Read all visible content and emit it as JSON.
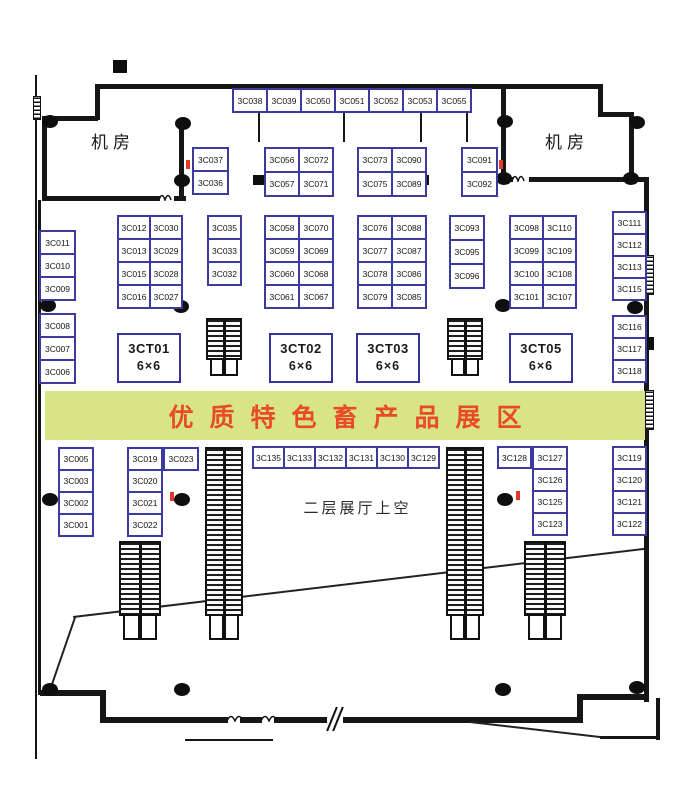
{
  "banner": {
    "text": "优质特色畜产品展区"
  },
  "labels": {
    "machine_room_left": "机房",
    "machine_room_right": "机房",
    "atrium": "二层展厅上空"
  },
  "ct_booths": [
    {
      "name": "3CT01",
      "size": "6×6"
    },
    {
      "name": "3CT02",
      "size": "6×6"
    },
    {
      "name": "3CT03",
      "size": "6×6"
    },
    {
      "name": "3CT05",
      "size": "6×6"
    }
  ],
  "booth_groups": [
    {
      "id": "top-row",
      "labels": [
        [
          "3C038",
          "3C039",
          "3C050",
          "3C051",
          "3C052",
          "3C053",
          "3C055"
        ]
      ]
    },
    {
      "id": "col-3637",
      "labels": [
        [
          "3C037"
        ],
        [
          "3C036"
        ]
      ]
    },
    {
      "id": "blk-56",
      "labels": [
        [
          "3C056",
          "3C072"
        ],
        [
          "3C057",
          "3C071"
        ]
      ]
    },
    {
      "id": "blk-73",
      "labels": [
        [
          "3C073",
          "3C090"
        ],
        [
          "3C075",
          "3C089"
        ]
      ]
    },
    {
      "id": "col-91",
      "labels": [
        [
          "3C091"
        ],
        [
          "3C092"
        ]
      ]
    },
    {
      "id": "col-11",
      "labels": [
        [
          "3C011"
        ],
        [
          "3C010"
        ],
        [
          "3C009"
        ]
      ]
    },
    {
      "id": "blk-12",
      "labels": [
        [
          "3C012",
          "3C030"
        ],
        [
          "3C013",
          "3C029"
        ],
        [
          "3C015",
          "3C028"
        ],
        [
          "3C016",
          "3C027"
        ]
      ]
    },
    {
      "id": "col-35",
      "labels": [
        [
          "3C035"
        ],
        [
          "3C033"
        ],
        [
          "3C032"
        ]
      ]
    },
    {
      "id": "blk-58",
      "labels": [
        [
          "3C058",
          "3C070"
        ],
        [
          "3C059",
          "3C069"
        ],
        [
          "3C060",
          "3C068"
        ],
        [
          "3C061",
          "3C067"
        ]
      ]
    },
    {
      "id": "blk-76",
      "labels": [
        [
          "3C076",
          "3C088"
        ],
        [
          "3C077",
          "3C087"
        ],
        [
          "3C078",
          "3C086"
        ],
        [
          "3C079",
          "3C085"
        ]
      ]
    },
    {
      "id": "col-93",
      "labels": [
        [
          "3C093"
        ],
        [
          "3C095"
        ],
        [
          "3C096"
        ]
      ]
    },
    {
      "id": "blk-98",
      "labels": [
        [
          "3C098",
          "3C110"
        ],
        [
          "3C099",
          "3C109"
        ],
        [
          "3C100",
          "3C108"
        ],
        [
          "3C101",
          "3C107"
        ]
      ]
    },
    {
      "id": "col-111",
      "labels": [
        [
          "3C111"
        ],
        [
          "3C112"
        ],
        [
          "3C113"
        ],
        [
          "3C115"
        ]
      ]
    },
    {
      "id": "col-116",
      "labels": [
        [
          "3C116"
        ],
        [
          "3C117"
        ],
        [
          "3C118"
        ]
      ]
    },
    {
      "id": "col-08",
      "labels": [
        [
          "3C008"
        ],
        [
          "3C007"
        ],
        [
          "3C006"
        ]
      ]
    },
    {
      "id": "col-05",
      "labels": [
        [
          "3C005"
        ],
        [
          "3C003"
        ],
        [
          "3C002"
        ],
        [
          "3C001"
        ]
      ]
    },
    {
      "id": "col-19",
      "labels": [
        [
          "3C019"
        ],
        [
          "3C020"
        ],
        [
          "3C021"
        ],
        [
          "3C022"
        ]
      ]
    },
    {
      "id": "cell-23",
      "labels": [
        [
          "3C023"
        ]
      ]
    },
    {
      "id": "row-135",
      "labels": [
        [
          "3C135",
          "3C133",
          "3C132",
          "3C131",
          "3C130",
          "3C129"
        ]
      ]
    },
    {
      "id": "cell-128",
      "labels": [
        [
          "3C128"
        ]
      ]
    },
    {
      "id": "col-127",
      "labels": [
        [
          "3C127"
        ],
        [
          "3C126"
        ],
        [
          "3C125"
        ],
        [
          "3C123"
        ]
      ]
    },
    {
      "id": "col-119",
      "labels": [
        [
          "3C119"
        ],
        [
          "3C120"
        ],
        [
          "3C121"
        ],
        [
          "3C122"
        ]
      ]
    }
  ],
  "colors": {
    "booth_border": "#3a3aa0",
    "banner_bg": "#d9e487",
    "banner_text": "#e84b28",
    "wall": "#161616",
    "red_marker": "#e0392b"
  }
}
